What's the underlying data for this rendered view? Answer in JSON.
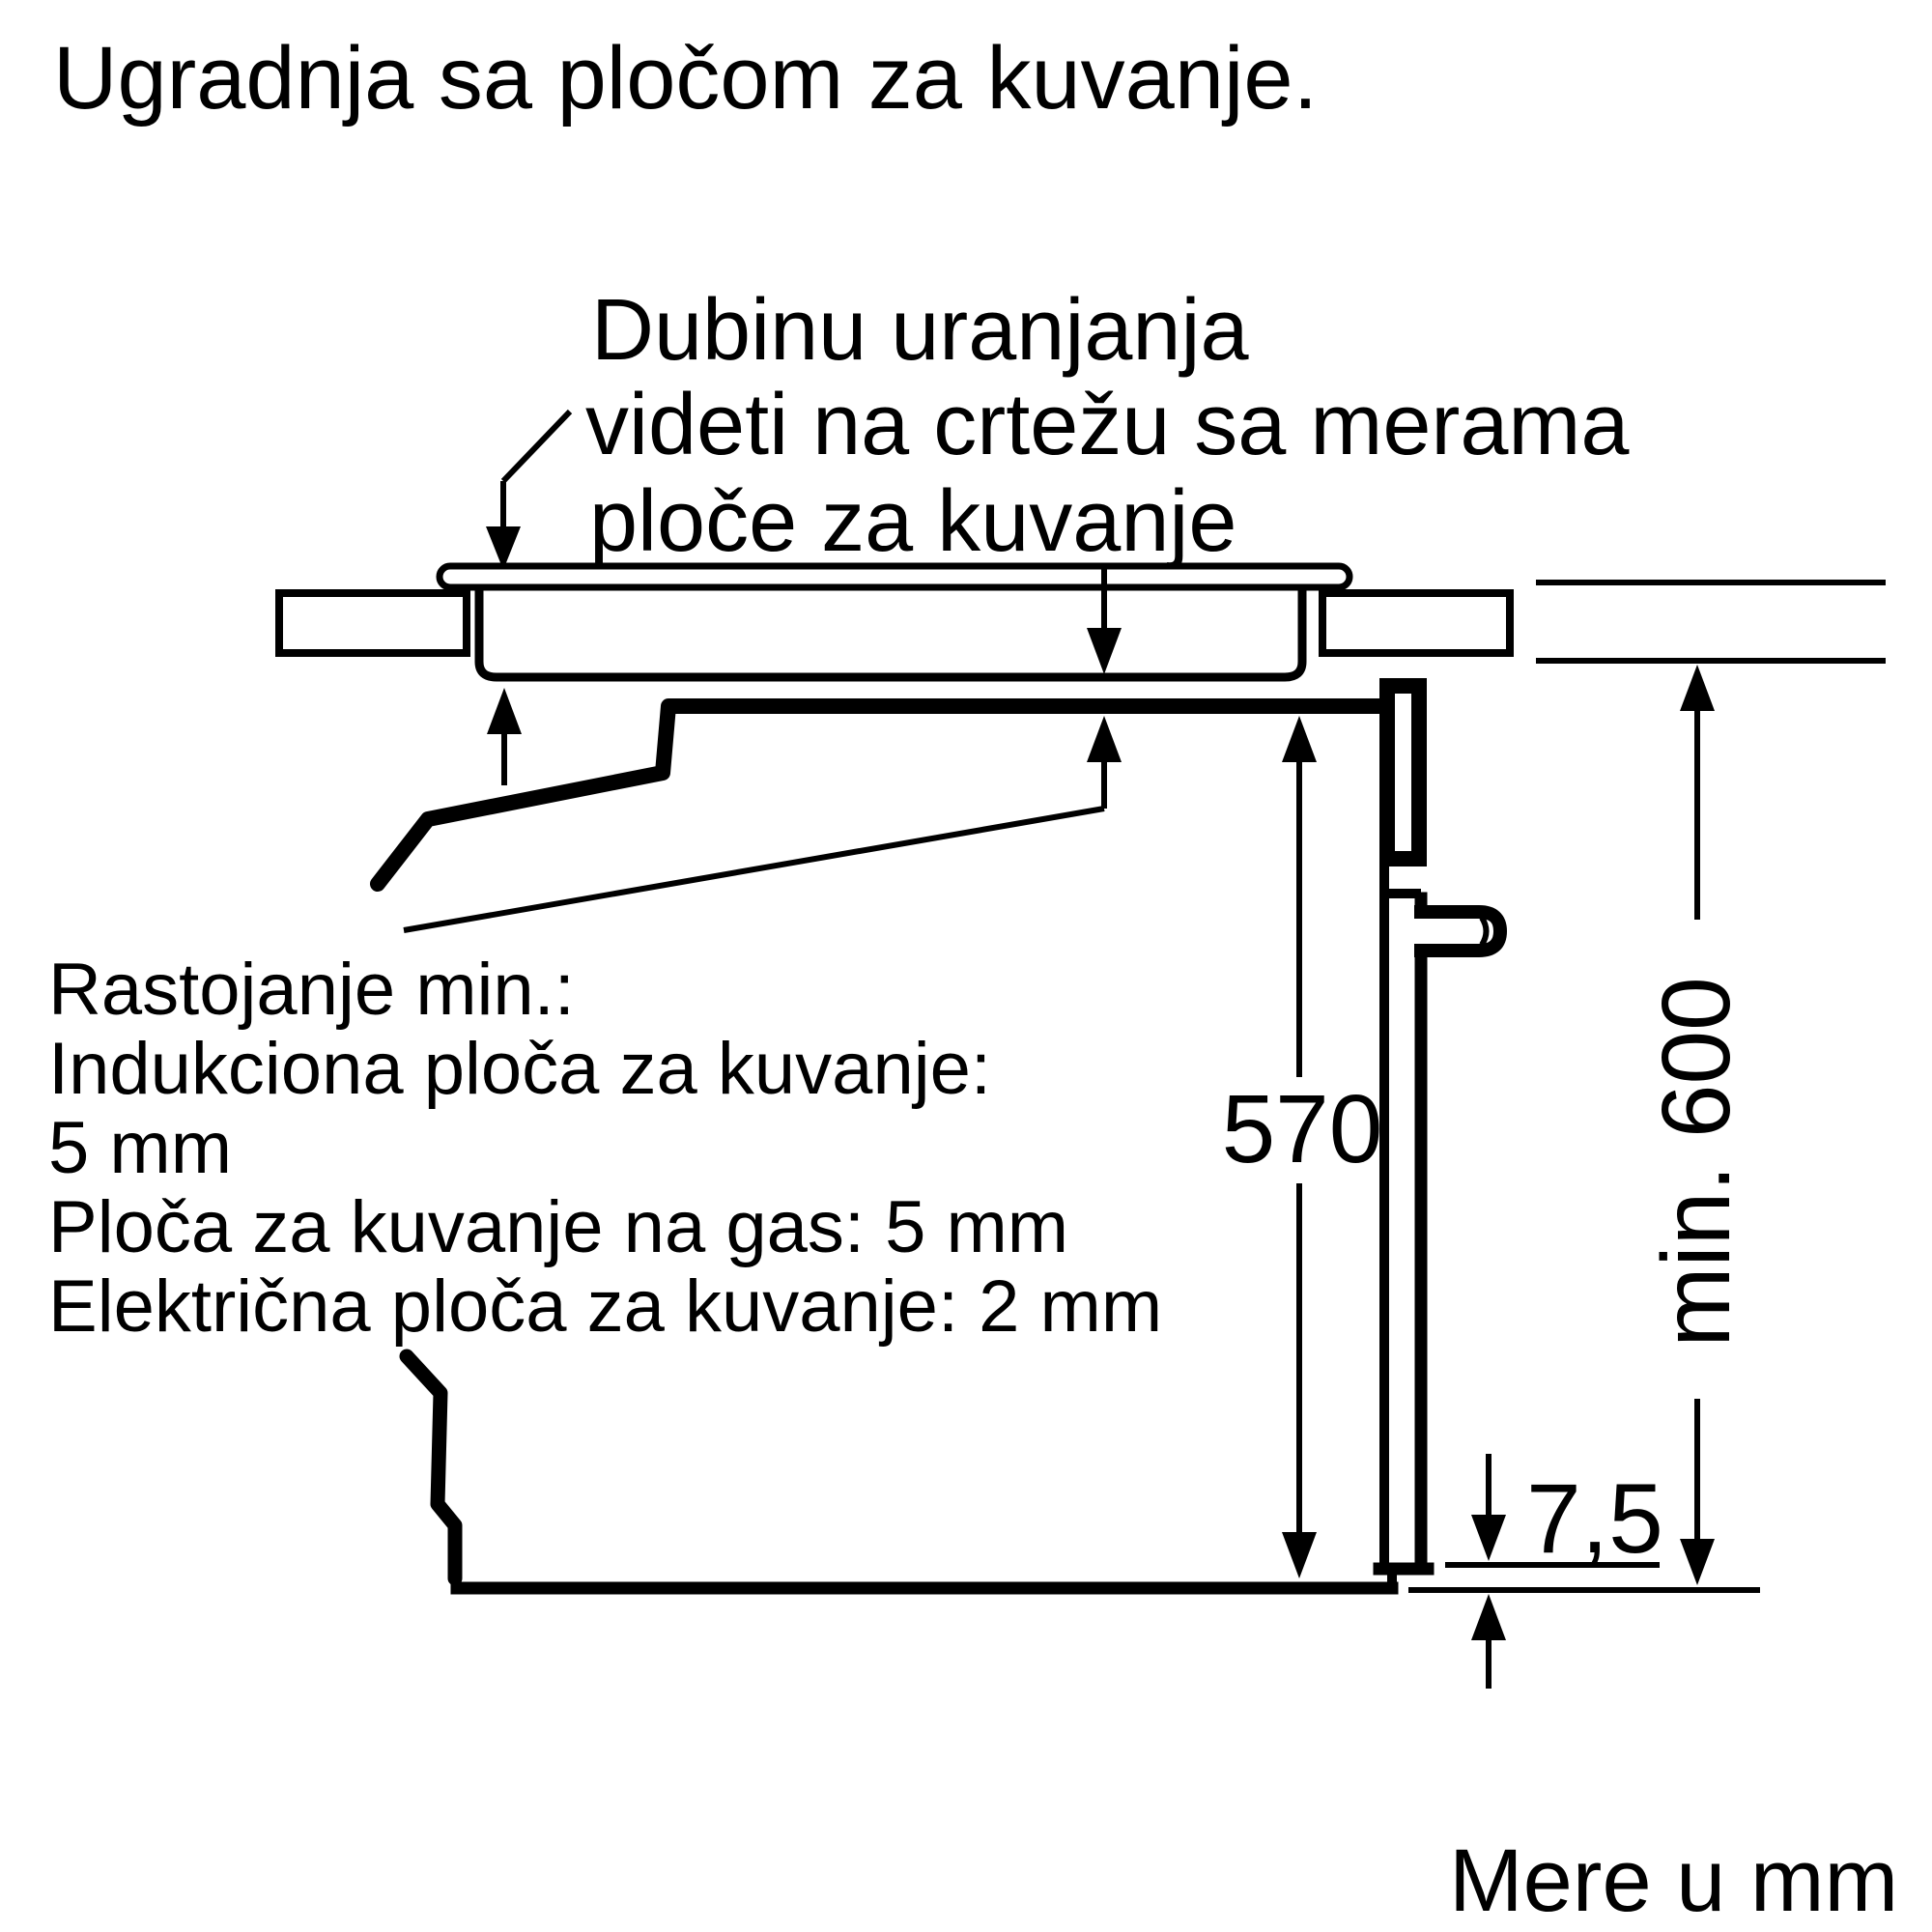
{
  "title": "Ugradnja sa pločom za kuvanje.",
  "annotation": {
    "line1": "Dubinu uranjanja",
    "line2": "videti na crtežu sa merama",
    "line3": "ploče za kuvanje"
  },
  "notes": {
    "line1": "Rastojanje min.:",
    "line2": "Indukciona ploča za kuvanje:",
    "line3": "5 mm",
    "line4": "Ploča za kuvanje na gas: 5 mm",
    "line5": "Električna ploča za kuvanje: 2 mm"
  },
  "dimensions": {
    "oven_height": "570",
    "niche_height": "min. 600",
    "door_gap": "7,5"
  },
  "footer": "Mere u mm",
  "colors": {
    "ink": "#000000",
    "background": "#ffffff"
  }
}
